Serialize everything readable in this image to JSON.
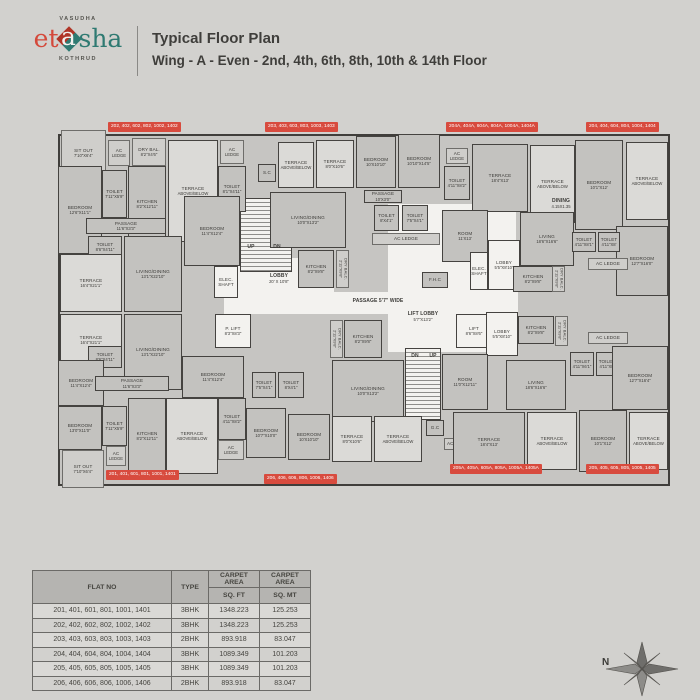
{
  "header": {
    "brand_top": "VASUDHA",
    "brand_left": "et",
    "brand_mid": "a",
    "brand_right": "sha",
    "brand_bottom": "KOTHRUD",
    "title_line1": "Typical Floor Plan",
    "title_line2": "Wing - A - Even - 2nd, 4th, 6th, 8th, 10th & 14th Floor"
  },
  "colors": {
    "page_bg": "#d2d1ce",
    "wall": "#403e3b",
    "room_fill": "#c3c2bf",
    "terrace_fill": "#dbdad7",
    "white_fill": "#f3f2ef",
    "tag_red": "#d84b3e",
    "logo_red": "#d4493b",
    "logo_teal": "#2f7a72"
  },
  "plan": {
    "compass_label": "N",
    "rooms": [
      {
        "l": "",
        "d": "",
        "x": 166,
        "y": 184,
        "w": 294,
        "h": 22,
        "k": "zone"
      },
      {
        "l": "",
        "d": "",
        "x": 172,
        "y": 150,
        "w": 104,
        "h": 48,
        "k": "zone"
      },
      {
        "l": "",
        "d": "",
        "x": 330,
        "y": 96,
        "w": 128,
        "h": 148,
        "k": "zone"
      },
      {
        "l": "",
        "d": "",
        "x": 182,
        "y": 90,
        "w": 52,
        "h": 74,
        "k": "stairs"
      },
      {
        "l": "",
        "d": "",
        "x": 347,
        "y": 240,
        "w": 36,
        "h": 72,
        "k": "stairs"
      },
      {
        "l": "SIT OUT",
        "d": "7'10\"X6'4\"",
        "x": 3,
        "y": 22,
        "w": 45,
        "h": 46,
        "k": "light"
      },
      {
        "l": "AC",
        "d": "LEDGE",
        "x": 50,
        "y": 32,
        "w": 22,
        "h": 26,
        "k": "light"
      },
      {
        "l": "DRY BAL.",
        "d": "8'2\"X4'6\"",
        "x": 74,
        "y": 30,
        "w": 34,
        "h": 28,
        "k": "light"
      },
      {
        "l": "BEDROOM",
        "d": "12'6\"X11'1\"",
        "x": 0,
        "y": 58,
        "w": 44,
        "h": 88,
        "k": "room"
      },
      {
        "l": "TOILET",
        "d": "7'11\"X5'9\"",
        "x": 44,
        "y": 62,
        "w": 25,
        "h": 48,
        "k": "room"
      },
      {
        "l": "KITCHEN",
        "d": "8'2\"X12'11\"",
        "x": 70,
        "y": 58,
        "w": 38,
        "h": 76,
        "k": "room"
      },
      {
        "l": "TERRACE",
        "d": "ABOVE/BELOW",
        "x": 110,
        "y": 32,
        "w": 50,
        "h": 102,
        "k": "terrace"
      },
      {
        "l": "AC",
        "d": "LEDGE",
        "x": 162,
        "y": 32,
        "w": 24,
        "h": 24,
        "k": "light"
      },
      {
        "l": "TOILET",
        "d": "8'1\"X4'11\"",
        "x": 160,
        "y": 58,
        "w": 28,
        "h": 46,
        "k": "room"
      },
      {
        "l": "PASSAGE",
        "d": "11'6\"X3'3\"",
        "x": 28,
        "y": 110,
        "w": 80,
        "h": 16,
        "k": "room"
      },
      {
        "l": "TOILET",
        "d": "8'6\"X4'11\"",
        "x": 30,
        "y": 128,
        "w": 34,
        "h": 22,
        "k": "room"
      },
      {
        "l": "TERRACE",
        "d": "16'4\"X21'1\"",
        "x": 2,
        "y": 146,
        "w": 62,
        "h": 58,
        "k": "terrace"
      },
      {
        "l": "LIVING/DINING",
        "d": "13'1\"X22'10\"",
        "x": 66,
        "y": 128,
        "w": 58,
        "h": 76,
        "k": "room"
      },
      {
        "l": "BEDROOM",
        "d": "11'4\"X12'4\"",
        "x": 126,
        "y": 88,
        "w": 56,
        "h": 70,
        "k": "room"
      },
      {
        "l": "TERRACE",
        "d": "16'4\"X21'1\"",
        "x": 2,
        "y": 206,
        "w": 62,
        "h": 52,
        "k": "terrace"
      },
      {
        "l": "LIVING/DINING",
        "d": "13'1\"X22'10\"",
        "x": 66,
        "y": 206,
        "w": 58,
        "h": 76,
        "k": "room"
      },
      {
        "l": "TOILET",
        "d": "8'6\"X4'11\"",
        "x": 30,
        "y": 238,
        "w": 34,
        "h": 22,
        "k": "room"
      },
      {
        "l": "BEDROOM",
        "d": "11'4\"X12'4\"",
        "x": 0,
        "y": 252,
        "w": 46,
        "h": 46,
        "k": "room"
      },
      {
        "l": "BEDROOM",
        "d": "13'0\"X11'0\"",
        "x": 0,
        "y": 298,
        "w": 44,
        "h": 44,
        "k": "room"
      },
      {
        "l": "SIT OUT",
        "d": "7'10\"X6'4\"",
        "x": 4,
        "y": 342,
        "w": 42,
        "h": 38,
        "k": "light"
      },
      {
        "l": "PASSAGE",
        "d": "11'6\"X3'3\"",
        "x": 37,
        "y": 268,
        "w": 74,
        "h": 15,
        "k": "room"
      },
      {
        "l": "TOILET",
        "d": "7'11\"X5'9\"",
        "x": 44,
        "y": 298,
        "w": 25,
        "h": 40,
        "k": "room"
      },
      {
        "l": "AC",
        "d": "LEDGE",
        "x": 48,
        "y": 338,
        "w": 20,
        "h": 20,
        "k": "light"
      },
      {
        "l": "KITCHEN",
        "d": "8'2\"X12'11\"",
        "x": 70,
        "y": 290,
        "w": 38,
        "h": 76,
        "k": "room"
      },
      {
        "l": "TERRACE",
        "d": "ABOVE/BELOW",
        "x": 108,
        "y": 290,
        "w": 52,
        "h": 76,
        "k": "terrace"
      },
      {
        "l": "TOILET",
        "d": "4'11\"X8'2\"",
        "x": 160,
        "y": 290,
        "w": 28,
        "h": 42,
        "k": "room"
      },
      {
        "l": "AC",
        "d": "LEDGE",
        "x": 160,
        "y": 332,
        "w": 26,
        "h": 20,
        "k": "light"
      },
      {
        "l": "BEDROOM",
        "d": "11'4\"X12'4\"",
        "x": 124,
        "y": 248,
        "w": 62,
        "h": 42,
        "k": "room"
      },
      {
        "l": "S.C",
        "d": "",
        "x": 200,
        "y": 56,
        "w": 18,
        "h": 18,
        "k": "room"
      },
      {
        "l": "TERRACE",
        "d": "ABOVE/BELOW",
        "x": 220,
        "y": 34,
        "w": 36,
        "h": 46,
        "k": "terrace"
      },
      {
        "l": "TERRACE",
        "d": "8'0\"X10'6\"",
        "x": 258,
        "y": 32,
        "w": 38,
        "h": 48,
        "k": "terrace"
      },
      {
        "l": "BEDROOM",
        "d": "10'X10'10\"",
        "x": 298,
        "y": 28,
        "w": 40,
        "h": 52,
        "k": "room"
      },
      {
        "l": "BEDROOM",
        "d": "10'10\"X14'5\"",
        "x": 340,
        "y": 26,
        "w": 42,
        "h": 54,
        "k": "room"
      },
      {
        "l": "PASSAGE",
        "d": "10'X3'0\"",
        "x": 306,
        "y": 82,
        "w": 38,
        "h": 13,
        "k": "room"
      },
      {
        "l": "TOILET",
        "d": "8'X4'1\"",
        "x": 316,
        "y": 97,
        "w": 25,
        "h": 26,
        "k": "room"
      },
      {
        "l": "TOILET",
        "d": "7'5\"X4'1\"",
        "x": 344,
        "y": 97,
        "w": 26,
        "h": 26,
        "k": "room"
      },
      {
        "l": "AC LEDGE",
        "d": "",
        "x": 314,
        "y": 125,
        "w": 68,
        "h": 12,
        "k": "light"
      },
      {
        "l": "LIVING/DINING",
        "d": "10'0\"X13'2\"",
        "x": 212,
        "y": 84,
        "w": 76,
        "h": 56,
        "k": "room"
      },
      {
        "l": "KITCHEN",
        "d": "8'2\"X9'8\"",
        "x": 240,
        "y": 142,
        "w": 36,
        "h": 38,
        "k": "room"
      },
      {
        "l": "DRY BALC.",
        "d": "2'11\"X9'8\"",
        "x": 278,
        "y": 142,
        "w": 13,
        "h": 38,
        "k": "light",
        "v": 1
      },
      {
        "l": "ELEC. SHAFT",
        "d": "",
        "x": 156,
        "y": 158,
        "w": 24,
        "h": 32,
        "k": "white"
      },
      {
        "l": "P. LIFT",
        "d": "8'3\"X8'3\"",
        "x": 157,
        "y": 206,
        "w": 36,
        "h": 34,
        "k": "white"
      },
      {
        "l": "LIFT",
        "d": "8'6\"X8'6\"",
        "x": 398,
        "y": 206,
        "w": 36,
        "h": 34,
        "k": "white"
      },
      {
        "l": "F.H.C",
        "d": "",
        "x": 364,
        "y": 164,
        "w": 26,
        "h": 16,
        "k": "room"
      },
      {
        "l": "KITCHEN",
        "d": "8'2\"X9'8\"",
        "x": 286,
        "y": 212,
        "w": 38,
        "h": 38,
        "k": "room"
      },
      {
        "l": "DRY BALC.",
        "d": "2'11\"X9'8\"",
        "x": 272,
        "y": 212,
        "w": 13,
        "h": 38,
        "k": "light",
        "v": 1
      },
      {
        "l": "LIVING/DINING",
        "d": "10'0\"X13'2\"",
        "x": 274,
        "y": 252,
        "w": 72,
        "h": 62,
        "k": "room"
      },
      {
        "l": "TOILET",
        "d": "7'5\"X4'1\"",
        "x": 194,
        "y": 264,
        "w": 24,
        "h": 26,
        "k": "room"
      },
      {
        "l": "TOILET",
        "d": "8'X4'1\"",
        "x": 220,
        "y": 264,
        "w": 26,
        "h": 26,
        "k": "room"
      },
      {
        "l": "BEDROOM",
        "d": "10'7\"X10'0\"",
        "x": 188,
        "y": 300,
        "w": 40,
        "h": 50,
        "k": "room"
      },
      {
        "l": "BEDROOM",
        "d": "10'X10'10\"",
        "x": 230,
        "y": 306,
        "w": 42,
        "h": 46,
        "k": "room"
      },
      {
        "l": "TERRACE",
        "d": "8'0\"X10'6\"",
        "x": 274,
        "y": 308,
        "w": 40,
        "h": 46,
        "k": "terrace"
      },
      {
        "l": "TERRACE",
        "d": "ABOVE/BELOW",
        "x": 316,
        "y": 308,
        "w": 48,
        "h": 46,
        "k": "terrace"
      },
      {
        "l": "G.C",
        "d": "",
        "x": 368,
        "y": 312,
        "w": 18,
        "h": 16,
        "k": "room"
      },
      {
        "l": "AC LEDGE",
        "d": "",
        "x": 386,
        "y": 330,
        "w": 30,
        "h": 12,
        "k": "light"
      },
      {
        "l": "AC",
        "d": "LEDGE",
        "x": 388,
        "y": 40,
        "w": 22,
        "h": 16,
        "k": "light"
      },
      {
        "l": "TOILET",
        "d": "4'11\"X8'2\"",
        "x": 386,
        "y": 58,
        "w": 26,
        "h": 34,
        "k": "room"
      },
      {
        "l": "TERRACE",
        "d": "18'4\"X13'",
        "x": 414,
        "y": 36,
        "w": 56,
        "h": 68,
        "k": "room"
      },
      {
        "l": "TERRACE",
        "d": "ABOVE/BELOW",
        "x": 472,
        "y": 37,
        "w": 45,
        "h": 78,
        "k": "terrace"
      },
      {
        "l": "BEDROOM",
        "d": "10'1\"X12'",
        "x": 517,
        "y": 32,
        "w": 48,
        "h": 90,
        "k": "room"
      },
      {
        "l": "TERRACE",
        "d": "ABOVE/BELOW",
        "x": 568,
        "y": 34,
        "w": 42,
        "h": 78,
        "k": "terrace"
      },
      {
        "l": "BEDROOM",
        "d": "12'7\"X16'0\"",
        "x": 558,
        "y": 118,
        "w": 52,
        "h": 70,
        "k": "room"
      },
      {
        "l": "ROOM",
        "d": "11'X13'",
        "x": 384,
        "y": 102,
        "w": 46,
        "h": 52,
        "k": "room"
      },
      {
        "l": "LOBBY",
        "d": "5'5\"X8'10\"",
        "x": 430,
        "y": 132,
        "w": 32,
        "h": 50,
        "k": "white"
      },
      {
        "l": "LIVING",
        "d": "18'6\"X16'6\"",
        "x": 462,
        "y": 104,
        "w": 54,
        "h": 54,
        "k": "room"
      },
      {
        "l": "DINING",
        "d": "4.15X1.35",
        "x": 487,
        "y": 88,
        "w": 32,
        "h": 15,
        "k": "plain"
      },
      {
        "l": "ELEC. SHAFT",
        "d": "",
        "x": 412,
        "y": 144,
        "w": 18,
        "h": 38,
        "k": "white"
      },
      {
        "l": "KITCHEN",
        "d": "8'2\"X9'8\"",
        "x": 455,
        "y": 158,
        "w": 40,
        "h": 26,
        "k": "room"
      },
      {
        "l": "DRY BALC.",
        "d": "2'11\"X9'8\"",
        "x": 494,
        "y": 158,
        "w": 13,
        "h": 26,
        "k": "light",
        "v": 1
      },
      {
        "l": "TOILET",
        "d": "4'11\"X8'1\"",
        "x": 514,
        "y": 124,
        "w": 24,
        "h": 20,
        "k": "room"
      },
      {
        "l": "TOILET",
        "d": "4'11\"X8'",
        "x": 540,
        "y": 124,
        "w": 22,
        "h": 20,
        "k": "room"
      },
      {
        "l": "AC LEDGE",
        "d": "",
        "x": 530,
        "y": 150,
        "w": 40,
        "h": 12,
        "k": "light"
      },
      {
        "l": "LOBBY",
        "d": "5'5\"X8'10\"",
        "x": 428,
        "y": 204,
        "w": 32,
        "h": 44,
        "k": "white"
      },
      {
        "l": "KITCHEN",
        "d": "8'2\"X9'8\"",
        "x": 460,
        "y": 208,
        "w": 36,
        "h": 28,
        "k": "room"
      },
      {
        "l": "DRY BALC.",
        "d": "2'11\"X9'8\"",
        "x": 497,
        "y": 208,
        "w": 13,
        "h": 30,
        "k": "light",
        "v": 1
      },
      {
        "l": "AC LEDGE",
        "d": "",
        "x": 530,
        "y": 224,
        "w": 40,
        "h": 12,
        "k": "light"
      },
      {
        "l": "TOILET",
        "d": "4'11\"X6'1\"",
        "x": 512,
        "y": 244,
        "w": 24,
        "h": 24,
        "k": "room"
      },
      {
        "l": "TOILET",
        "d": "4'11\"X8'",
        "x": 538,
        "y": 244,
        "w": 22,
        "h": 24,
        "k": "room"
      },
      {
        "l": "BEDROOM",
        "d": "12'7\"X16'4\"",
        "x": 554,
        "y": 238,
        "w": 56,
        "h": 64,
        "k": "room"
      },
      {
        "l": "ROOM",
        "d": "11'0\"X12'11\"",
        "x": 384,
        "y": 246,
        "w": 46,
        "h": 56,
        "k": "room"
      },
      {
        "l": "LIVING",
        "d": "18'6\"X16'6\"",
        "x": 448,
        "y": 252,
        "w": 60,
        "h": 50,
        "k": "room"
      },
      {
        "l": "TERRACE",
        "d": "18'4\"X13'",
        "x": 395,
        "y": 304,
        "w": 72,
        "h": 60,
        "k": "room"
      },
      {
        "l": "TERRACE",
        "d": "ABOVE/BELOW",
        "x": 469,
        "y": 304,
        "w": 50,
        "h": 58,
        "k": "terrace"
      },
      {
        "l": "BEDROOM",
        "d": "10'1\"X12'",
        "x": 521,
        "y": 302,
        "w": 48,
        "h": 62,
        "k": "room"
      },
      {
        "l": "TERRACE",
        "d": "ABOVE/BELOW",
        "x": 571,
        "y": 304,
        "w": 39,
        "h": 58,
        "k": "terrace"
      },
      {
        "l": "LOBBY",
        "d": "20' X 10'8\"",
        "x": 176,
        "y": 156,
        "w": 90,
        "h": 30,
        "k": "plain"
      },
      {
        "l": "PASSAGE 5'7\" WIDE",
        "d": "",
        "x": 262,
        "y": 186,
        "w": 116,
        "h": 14,
        "k": "plain"
      },
      {
        "l": "LIFT LOBBY",
        "d": "5'7\"X13'2\"",
        "x": 336,
        "y": 196,
        "w": 58,
        "h": 26,
        "k": "plain"
      },
      {
        "l": "UP",
        "d": "",
        "x": 186,
        "y": 134,
        "w": 14,
        "h": 10,
        "k": "plain"
      },
      {
        "l": "DN",
        "d": "",
        "x": 212,
        "y": 134,
        "w": 14,
        "h": 10,
        "k": "plain"
      },
      {
        "l": "DN",
        "d": "",
        "x": 350,
        "y": 243,
        "w": 14,
        "h": 10,
        "k": "plain"
      },
      {
        "l": "UP",
        "d": "",
        "x": 368,
        "y": 243,
        "w": 14,
        "h": 10,
        "k": "plain"
      }
    ],
    "tags": [
      {
        "text": "202, 402, 602, 802, 1002, 1402",
        "x": 50,
        "y": 14
      },
      {
        "text": "203, 403, 603, 803, 1003, 1403",
        "x": 207,
        "y": 14
      },
      {
        "text": "204A, 404A, 604A, 804A, 1004A, 1404A",
        "x": 388,
        "y": 14
      },
      {
        "text": "204, 404, 604, 804, 1004, 1404",
        "x": 528,
        "y": 14
      },
      {
        "text": "201, 401, 601, 801, 1001, 1401",
        "x": 48,
        "y": 362
      },
      {
        "text": "206, 406, 606, 806, 1006, 1406",
        "x": 206,
        "y": 366
      },
      {
        "text": "205A, 405A, 605A, 805A, 1005A, 1405A",
        "x": 392,
        "y": 356
      },
      {
        "text": "205, 405, 605, 805, 1005, 1405",
        "x": 528,
        "y": 356
      }
    ]
  },
  "table": {
    "col_flat": "FLAT  NO",
    "col_type": "TYPE",
    "col_carpet": "CARPET AREA",
    "col_sqft": "SQ. FT",
    "col_sqmt": "SQ. MT",
    "rows": [
      {
        "flats": "201, 401, 601, 801, 1001, 1401",
        "type": "3BHK",
        "sqft": "1348.223",
        "sqmt": "125.253"
      },
      {
        "flats": "202, 402, 602, 802, 1002, 1402",
        "type": "3BHK",
        "sqft": "1348.223",
        "sqmt": "125.253"
      },
      {
        "flats": "203, 403, 603, 803, 1003, 1403",
        "type": "2BHK",
        "sqft": "893.918",
        "sqmt": "83.047"
      },
      {
        "flats": "204, 404, 604, 804, 1004, 1404",
        "type": "3BHK",
        "sqft": "1089.349",
        "sqmt": "101.203"
      },
      {
        "flats": "205, 405, 605, 805, 1005, 1405",
        "type": "3BHK",
        "sqft": "1089.349",
        "sqmt": "101.203"
      },
      {
        "flats": "206, 406, 606, 806, 1006, 1406",
        "type": "2BHK",
        "sqft": "893.918",
        "sqmt": "83.047"
      }
    ]
  }
}
